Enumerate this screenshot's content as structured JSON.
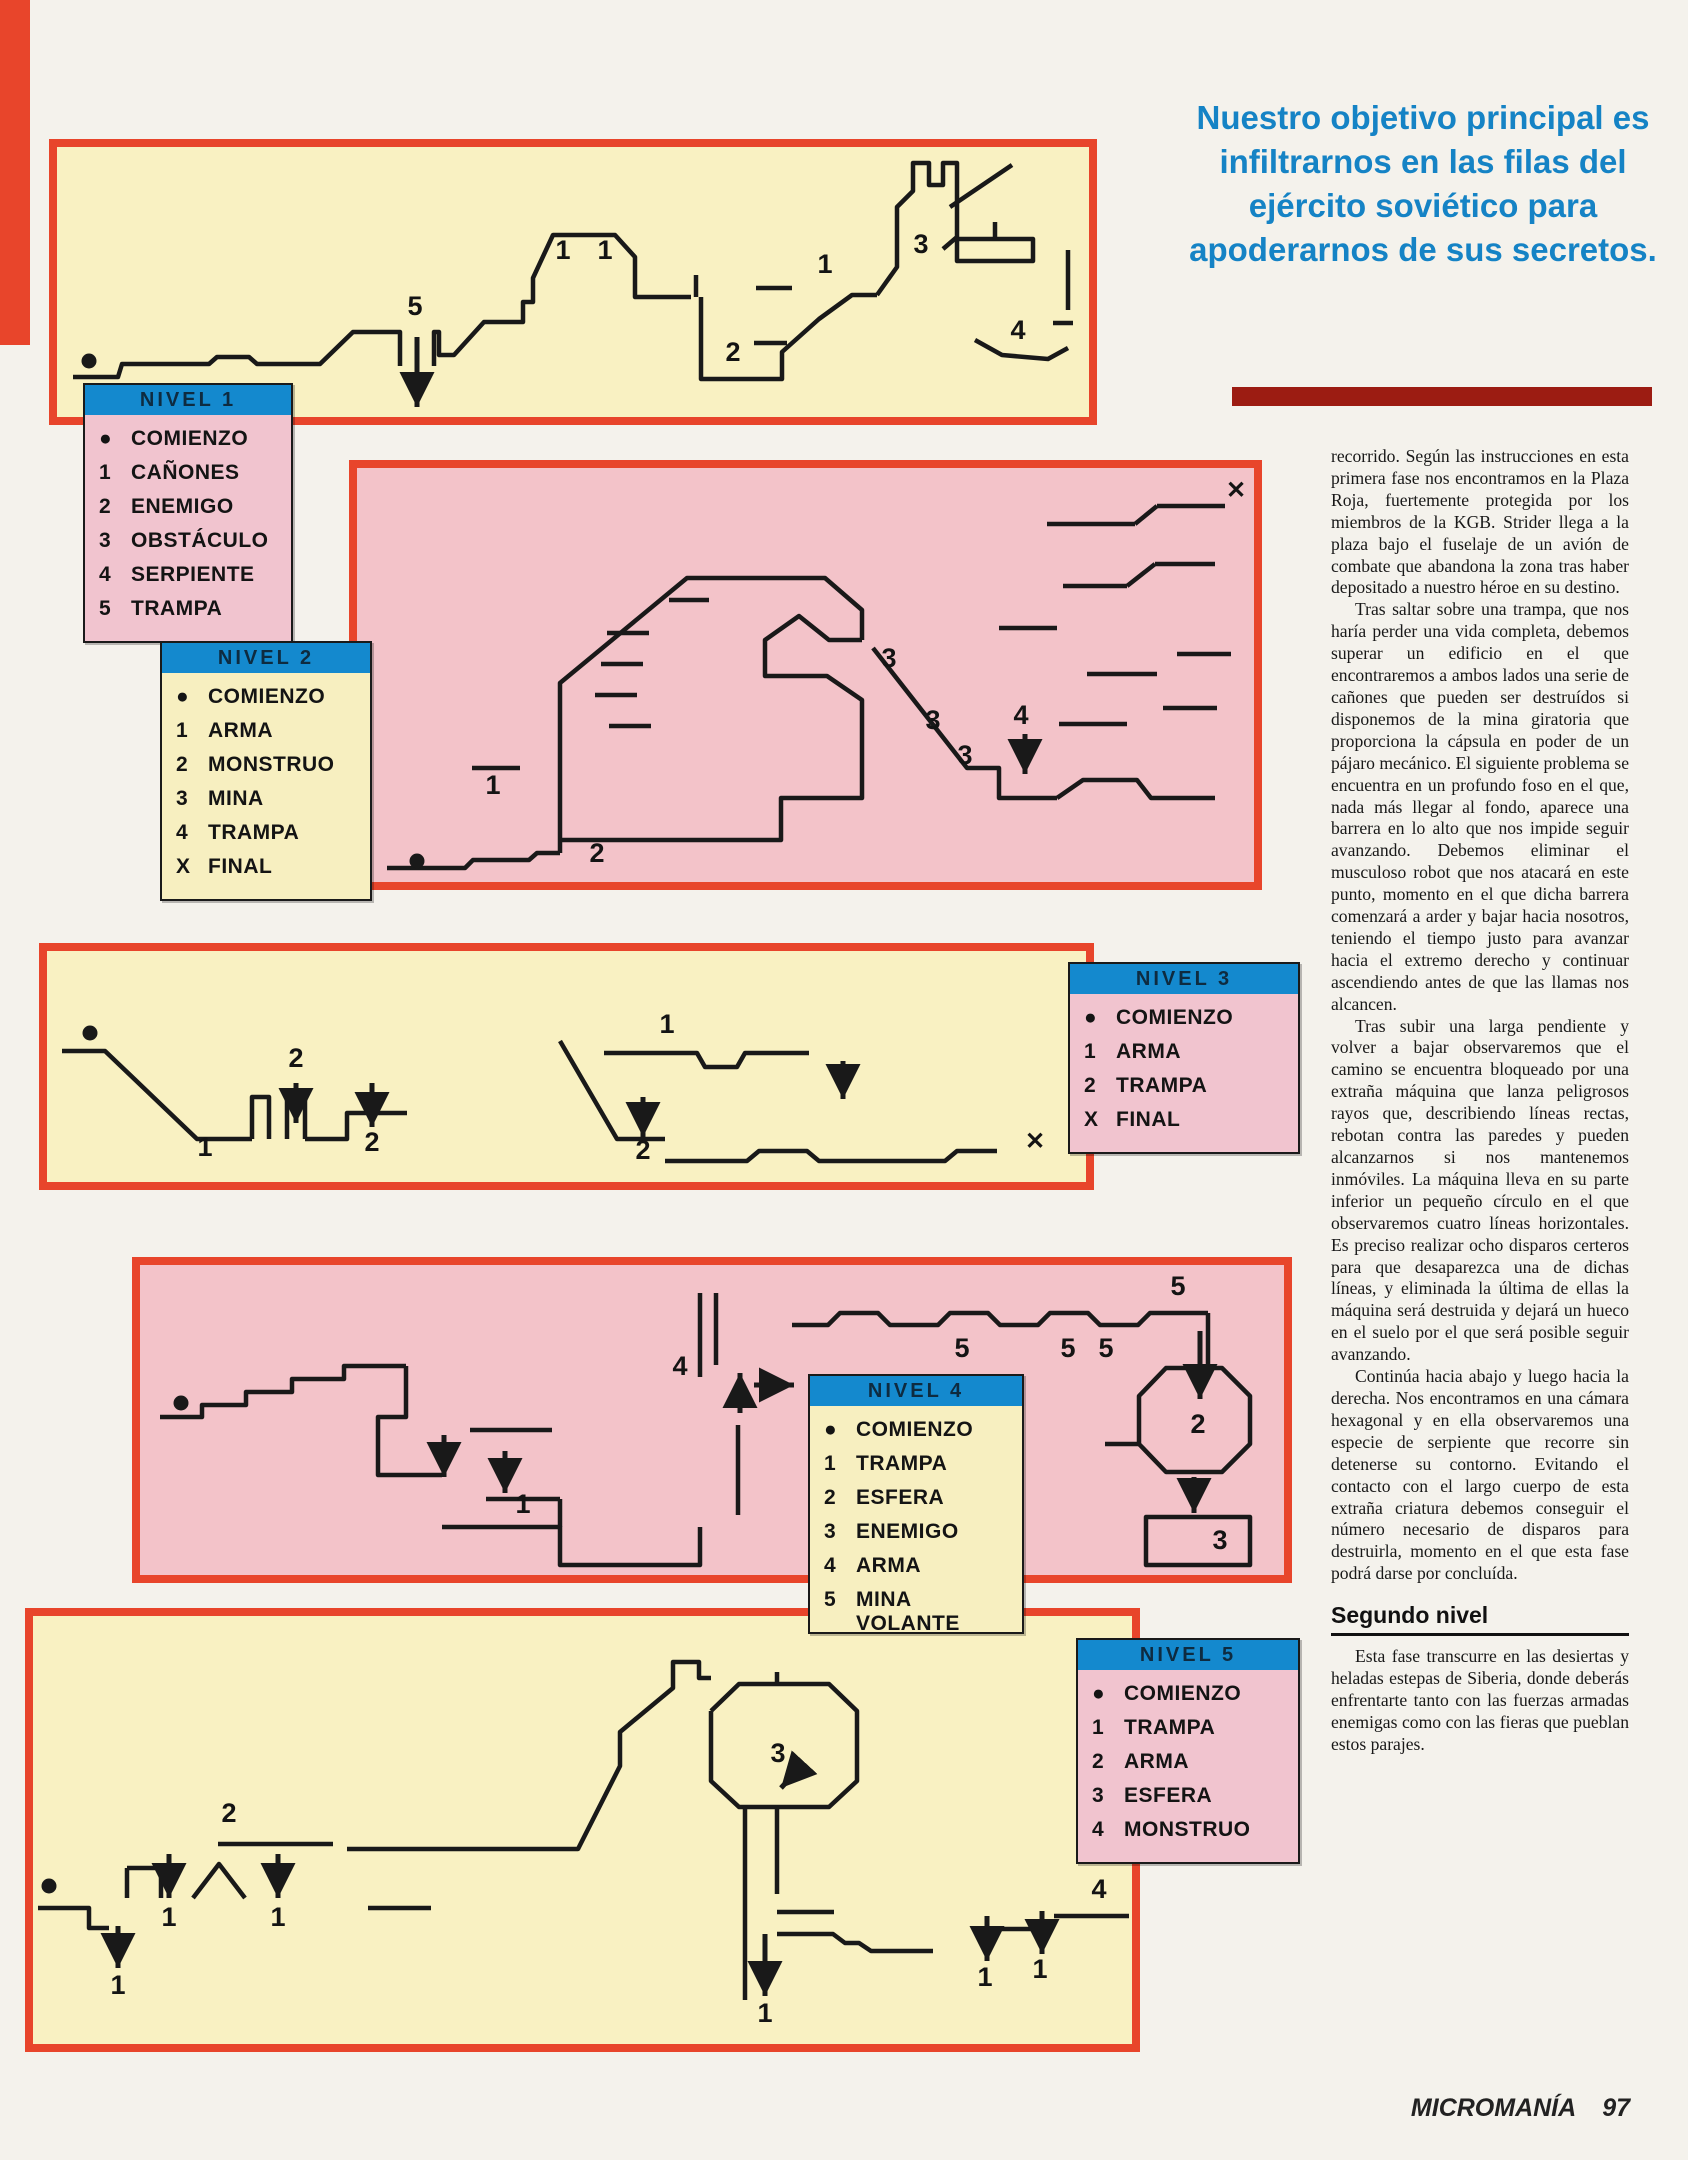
{
  "colors": {
    "panel_border_red": "#e8452b",
    "cream_panel": "#f9f1c2",
    "pink_panel": "#f3c3c9",
    "legend_header_blue": "#1489ce",
    "headline_blue": "#1583c5",
    "dark_rule_red": "#9c1c12",
    "ink": "#191919"
  },
  "headline": {
    "text": "Nuestro objetivo principal es infiltrarnos en las filas del ejército soviético para apoderarnos de sus secretos."
  },
  "article": {
    "paragraphs": [
      "recorrido. Según las instrucciones en esta primera fase nos encontramos en la Plaza Roja, fuertemente protegida por los miembros de la KGB. Strider llega a la plaza bajo el fuselaje de un avión de combate que abandona la zona tras haber depositado a nuestro héroe en su destino.",
      "Tras saltar sobre una trampa, que nos haría perder una vida completa, debemos superar un edificio en el que encontraremos a ambos lados una serie de cañones que pueden ser destruídos si disponemos de la mina giratoria que proporciona la cápsula en poder de un pájaro mecánico. El siguiente problema se encuentra en un profundo foso en el que, nada más llegar al fondo, aparece una barrera en lo alto que nos impide seguir avanzando. Debemos eliminar el musculoso robot que nos atacará en este punto, momento en el que dicha barrera comenzará a arder y bajar hacia nosotros, teniendo el tiempo justo para avanzar hacia el extremo derecho y continuar ascendiendo antes de que las llamas nos alcancen.",
      "Tras subir una larga pendiente y volver a bajar observaremos que el camino se encuentra bloqueado por una extraña máquina que lanza peligrosos rayos que, describiendo líneas rectas, rebotan contra las paredes y pueden alcanzarnos si nos mantenemos inmóviles. La máquina lleva en su parte inferior un pequeño círculo en el que observaremos cuatro líneas horizontales. Es preciso realizar ocho disparos certeros para que desaparezca una de dichas líneas, y eliminada la última de ellas la máquina será destruida y dejará un hueco en el suelo por el que será posible seguir avanzando.",
      "Continúa hacia abajo y luego hacia la derecha. Nos encontramos en una cámara hexagonal y en ella observaremos una especie de serpiente que recorre sin detenerse su contorno. Evitando el contacto con el largo cuerpo de esta extraña criatura debemos conseguir el número necesario de disparos para destruirla, momento en el que esta fase podrá darse por concluída."
    ],
    "subhead": "Segundo nivel",
    "paragraphs2": [
      "Esta fase transcurre en las desiertas y heladas estepas de Siberia, donde deberás enfrentarte tanto con las fuerzas armadas enemigas como con las fieras que pueblan estos parajes."
    ]
  },
  "footer": {
    "brand": "MICROMANÍA",
    "page": "97"
  },
  "legends": [
    {
      "title": "NIVEL 1",
      "items": [
        [
          "●",
          "COMIENZO"
        ],
        [
          "1",
          "CAÑONES"
        ],
        [
          "2",
          "ENEMIGO"
        ],
        [
          "3",
          "OBSTÁCULO"
        ],
        [
          "4",
          "SERPIENTE"
        ],
        [
          "5",
          "TRAMPA"
        ]
      ]
    },
    {
      "title": "NIVEL 2",
      "items": [
        [
          "●",
          "COMIENZO"
        ],
        [
          "1",
          "ARMA"
        ],
        [
          "2",
          "MONSTRUO"
        ],
        [
          "3",
          "MINA"
        ],
        [
          "4",
          "TRAMPA"
        ],
        [
          "X",
          "FINAL"
        ]
      ]
    },
    {
      "title": "NIVEL 3",
      "items": [
        [
          "●",
          "COMIENZO"
        ],
        [
          "1",
          "ARMA"
        ],
        [
          "2",
          "TRAMPA"
        ],
        [
          "X",
          "FINAL"
        ]
      ]
    },
    {
      "title": "NIVEL 4",
      "items": [
        [
          "●",
          "COMIENZO"
        ],
        [
          "1",
          "TRAMPA"
        ],
        [
          "2",
          "ESFERA"
        ],
        [
          "3",
          "ENEMIGO"
        ],
        [
          "4",
          "ARMA"
        ],
        [
          "5",
          "MINA VOLANTE"
        ]
      ]
    },
    {
      "title": "NIVEL 5",
      "items": [
        [
          "●",
          "COMIENZO"
        ],
        [
          "1",
          "TRAMPA"
        ],
        [
          "2",
          "ARMA"
        ],
        [
          "3",
          "ESFERA"
        ],
        [
          "4",
          "MONSTRUO"
        ]
      ]
    }
  ],
  "maps": [
    {
      "name": "nivel-1",
      "w": 1032,
      "h": 270,
      "paths": [
        "M16,230 L61,230 L65,217 L152,217 L160,210 L192,210 L200,217 L263,217 L296,185 L343,185 L343,219",
        "M377,219 L377,185 L382,185 L382,208 L397,208 L427,175 L466,175 L466,155 L476,155 L476,131 L496,88 L558,88 L578,110 L578,150 L634,150",
        "M639,150 L639,128",
        "M644,150 L644,232 L725,232 L725,205 L762,172 L795,148 L820,148",
        "M697,196 L730,196",
        "M699,141 L735,141",
        "M820,148 L840,120 L840,60 L856,44 L856,16 L872,16 L872,38 L886,38 L886,16 L900,16 L900,90 L886,102",
        "M900,92 L976,92 L976,114 L900,114 Z",
        "M938,75 L938,92",
        "M1011,103 L1011,163",
        "M918,193 L945,208 L991,212 L1011,201",
        "M996,176 L1016,176",
        "M893,60 L955,18"
      ],
      "dots": [
        [
          32,
          214
        ]
      ],
      "arrows": [
        [
          360,
          190,
          360,
          260
        ]
      ],
      "labels": [
        [
          "5",
          358,
          168
        ],
        [
          "1",
          506,
          112
        ],
        [
          "1",
          548,
          112
        ],
        [
          "2",
          676,
          214
        ],
        [
          "1",
          768,
          126
        ],
        [
          "3",
          864,
          106
        ],
        [
          "4",
          961,
          192
        ]
      ]
    },
    {
      "name": "nivel-2",
      "w": 897,
      "h": 414,
      "paths": [
        "M30,400 L108,400 L116,392 L172,392 L180,385 L203,385",
        "M203,385 L203,215 L330,110 L468,110 L505,142 L505,172",
        "M505,172 L472,172 L442,148 L408,172 L408,208 L470,208 L505,232 L505,330 L424,330 L424,372 L203,372",
        "M516,180 L610,300 L642,300 L642,330 L700,330",
        "M700,330 L726,312 L780,312 L794,330 L858,330",
        "M115,300 L163,300",
        "M250,165 L292,165",
        "M244,196 L286,196",
        "M238,227 L280,227",
        "M252,258 L294,258",
        "M312,132 L352,132",
        "M690,56 L778,56",
        "M800,38 L868,38",
        "M778,56 L800,38",
        "M706,118 L770,118",
        "M798,96 L858,96",
        "M770,118 L798,96",
        "M642,160 L700,160",
        "M730,206 L800,206",
        "M820,186 L874,186",
        "M702,256 L770,256",
        "M806,240 L860,240"
      ],
      "dots": [
        [
          60,
          393
        ]
      ],
      "arrows": [
        [
          668,
          266,
          668,
          306
        ]
      ],
      "labels": [
        [
          "3",
          532,
          199
        ],
        [
          "3",
          576,
          261
        ],
        [
          "3",
          608,
          296
        ],
        [
          "4",
          664,
          256
        ],
        [
          "1",
          136,
          326
        ],
        [
          "2",
          240,
          394
        ],
        [
          "✕",
          879,
          30
        ]
      ]
    },
    {
      "name": "nivel-3",
      "w": 1039,
      "h": 231,
      "paths": [
        "M15,100 L58,100 L150,188 L205,188",
        "M205,188 L205,146 L222,146 L222,188",
        "M240,188 L240,146 L258,146 L258,188",
        "M258,188 L300,188 L300,162 L360,162",
        "M513,90 L570,188 L618,188",
        "M557,102 L650,102 L658,116 L690,116 L698,102 L762,102",
        "M618,210 L700,210 L712,200 L760,200 L772,210 L898,210 L910,200 L950,200"
      ],
      "dots": [
        [
          43,
          82
        ]
      ],
      "arrows": [
        [
          249,
          132,
          249,
          172
        ],
        [
          325,
          132,
          325,
          176
        ],
        [
          596,
          146,
          596,
          186
        ],
        [
          796,
          110,
          796,
          148
        ]
      ],
      "labels": [
        [
          "2",
          249,
          116
        ],
        [
          "1",
          158,
          205
        ],
        [
          "2",
          325,
          200
        ],
        [
          "1",
          620,
          82
        ],
        [
          "2",
          596,
          208
        ],
        [
          "✕",
          988,
          198
        ]
      ]
    },
    {
      "name": "nivel-4",
      "w": 1144,
      "h": 310,
      "paths": [
        "M20,152 L62,152 L62,140 L106,140 L106,127 L152,127 L152,114 L204,114 L204,101 L266,101",
        "M266,101 L266,152 L238,152 L238,210 L302,210",
        "M330,165 L412,165",
        "M346,234 L420,234",
        "M420,234 L420,262",
        "M302,262 L420,262 L420,300 L560,300 L560,262",
        "M560,28 L560,112",
        "M576,28 L576,100",
        "M598,160 L598,250",
        "M652,60 L688,60 L700,48 L738,48 L750,60 L798,60 L810,48 L848,48 L860,60 L898,60 L910,48 L948,48 L960,60 L998,60 L1010,48 L1068,48",
        "M1068,48 L1068,100",
        "M1026,103 L1082,103 L1110,131 L1110,179 L1082,207 L1026,207 L999,179 L999,131 Z",
        "M999,179 L965,179",
        "M1006,252 L1110,252 L1110,300 L1006,300 Z"
      ],
      "dots": [
        [
          41,
          138
        ]
      ],
      "arrows": [
        [
          304,
          170,
          304,
          212
        ],
        [
          365,
          186,
          365,
          228
        ],
        [
          600,
          148,
          600,
          108
        ],
        [
          614,
          120,
          654,
          120
        ],
        [
          1060,
          66,
          1060,
          134
        ],
        [
          1054,
          212,
          1054,
          248
        ]
      ],
      "labels": [
        [
          "1",
          383,
          248
        ],
        [
          "4",
          540,
          110
        ],
        [
          "5",
          822,
          92
        ],
        [
          "5",
          928,
          92
        ],
        [
          "5",
          966,
          92
        ],
        [
          "5",
          1038,
          30
        ],
        [
          "2",
          1058,
          168
        ],
        [
          "3",
          1080,
          284
        ]
      ]
    },
    {
      "name": "nivel-5",
      "w": 1099,
      "h": 428,
      "paths": [
        "M5,292 L56,292 L56,312 L76,312",
        "M94,252 L94,282",
        "M94,252 L128,252 L128,282",
        "M160,282 L186,248 L212,282",
        "M185,228 L300,228",
        "M335,292 L398,292",
        "M314,233 L500,233",
        "M500,233 L545,233 L587,150 L587,116 L640,72 L640,46 L666,46 L666,62 L678,62",
        "M678,95 L706,68 L744,68",
        "M744,68 L744,56",
        "M744,68 L796,68 L824,95 L824,165 L796,191 L706,191 L678,165 L678,95",
        "M712,191 L712,384",
        "M744,191 L744,278",
        "M744,296 L801,296",
        "M744,318 L800,318 L812,327 L826,327 L838,335 L900,335",
        "M964,313 L1001,313",
        "M1021,300 L1096,300"
      ],
      "dots": [
        [
          16,
          270
        ]
      ],
      "arrows": [
        [
          136,
          238,
          136,
          282
        ],
        [
          245,
          238,
          245,
          282
        ],
        [
          85,
          310,
          85,
          352
        ],
        [
          770,
          148,
          748,
          172
        ],
        [
          732,
          318,
          732,
          380
        ],
        [
          954,
          300,
          954,
          345
        ],
        [
          1009,
          295,
          1009,
          338
        ]
      ],
      "labels": [
        [
          "2",
          196,
          206
        ],
        [
          "1",
          136,
          310
        ],
        [
          "1",
          245,
          310
        ],
        [
          "1",
          85,
          378
        ],
        [
          "3",
          745,
          146
        ],
        [
          "1",
          732,
          406
        ],
        [
          "1",
          952,
          370
        ],
        [
          "1",
          1007,
          362
        ],
        [
          "4",
          1066,
          282
        ]
      ]
    }
  ]
}
